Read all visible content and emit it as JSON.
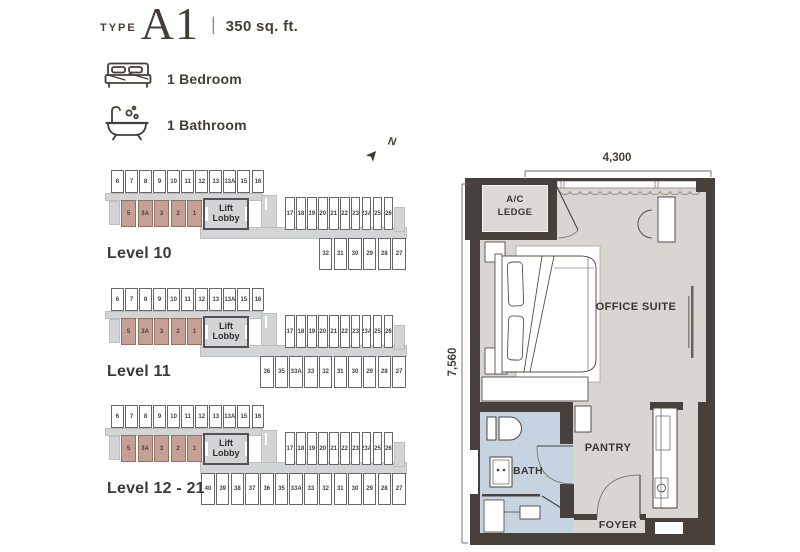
{
  "title": {
    "type_label": "TYPE",
    "unit_code": "A1",
    "separator": "|",
    "area": "350 sq. ft."
  },
  "features": [
    {
      "icon": "bed-icon",
      "label": "1 Bedroom"
    },
    {
      "icon": "bathtub-icon",
      "label": "1 Bathroom"
    }
  ],
  "compass": {
    "label": "N"
  },
  "levels": [
    {
      "label": "Level 10",
      "top_row": [
        "6",
        "7",
        "8",
        "9",
        "10",
        "11",
        "12",
        "13",
        "13A",
        "15",
        "16"
      ],
      "highlighted_row": [
        "5",
        "3A",
        "3",
        "2",
        "1"
      ],
      "lobby_label": "Lift Lobby",
      "right_row": [
        "17",
        "18",
        "19",
        "20",
        "21",
        "22",
        "23",
        "23A",
        "25",
        "26"
      ],
      "bottom_row": [
        "32",
        "31",
        "30",
        "29",
        "28",
        "27"
      ]
    },
    {
      "label": "Level 11",
      "top_row": [
        "6",
        "7",
        "8",
        "9",
        "10",
        "11",
        "12",
        "13",
        "13A",
        "15",
        "16"
      ],
      "highlighted_row": [
        "5",
        "3A",
        "3",
        "2",
        "1"
      ],
      "lobby_label": "Lift Lobby",
      "right_row": [
        "17",
        "18",
        "19",
        "20",
        "21",
        "22",
        "23",
        "23A",
        "25",
        "26"
      ],
      "bottom_row": [
        "36",
        "35",
        "33A",
        "33",
        "32",
        "31",
        "30",
        "29",
        "28",
        "27"
      ]
    },
    {
      "label": "Level 12 - 21",
      "top_row": [
        "6",
        "7",
        "8",
        "9",
        "10",
        "11",
        "12",
        "13",
        "13A",
        "15",
        "16"
      ],
      "highlighted_row": [
        "5",
        "3A",
        "3",
        "2",
        "1"
      ],
      "lobby_label": "Lift Lobby",
      "right_row": [
        "17",
        "18",
        "19",
        "20",
        "21",
        "22",
        "23",
        "23A",
        "25",
        "26"
      ],
      "bottom_row": [
        "40",
        "39",
        "38",
        "37",
        "36",
        "35",
        "33A",
        "33",
        "32",
        "31",
        "30",
        "29",
        "28",
        "27"
      ]
    }
  ],
  "floor_plan": {
    "dimensions": {
      "width": "4,300",
      "height": "7,560"
    },
    "rooms": {
      "ac_ledge": "A/C LEDGE",
      "office": "OFFICE SUITE",
      "pantry": "PANTRY",
      "bath": "BATH",
      "foyer": "FOYER"
    }
  },
  "colors": {
    "highlight_unit": "#c7a095",
    "corridor": "#d3d4d6",
    "wall": "#48403a",
    "room_fill": "#d9d5d1",
    "bath_fill": "#c6d4e2",
    "text": "#453e38"
  }
}
